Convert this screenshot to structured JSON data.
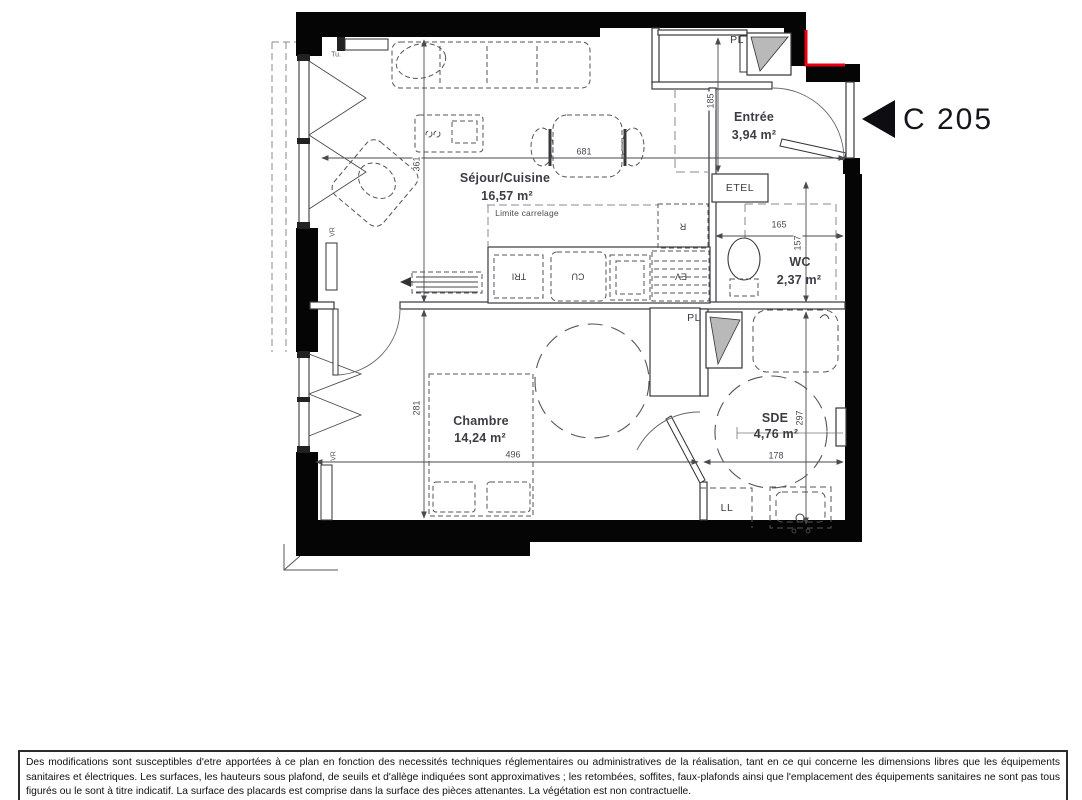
{
  "unit_label": "C 205",
  "rooms": {
    "sejour": {
      "name": "Séjour/Cuisine",
      "area": "16,57 m²"
    },
    "entree": {
      "name": "Entrée",
      "area": "3,94 m²"
    },
    "wc": {
      "name": "WC",
      "area": "2,37 m²"
    },
    "chambre": {
      "name": "Chambre",
      "area": "14,24 m²"
    },
    "sde": {
      "name": "SDE",
      "area": "4,76 m²"
    }
  },
  "labels": {
    "limite_carrelage": "Limite carrelage",
    "pl_top": "PL",
    "pl_mid": "PL",
    "etel": "ETEL",
    "tri": "TRI",
    "cu": "CU",
    "ev": "EV",
    "fridge": "R",
    "ll": "LL",
    "vr_sejour": "VR",
    "vr_chambre": "VR",
    "tu": "Tu."
  },
  "dimensions": {
    "sejour_width": "681",
    "sejour_height": "361",
    "entree_height": "185",
    "wc_width": "165",
    "wc_height": "157",
    "chambre_height": "281",
    "chambre_width": "496",
    "sde_width": "178",
    "sde_height": "297"
  },
  "colors": {
    "wall": "#050505",
    "line": "#38383c",
    "dashed": "#55555a",
    "accent_red": "#e8000f",
    "label": "#3c3c44"
  },
  "disclaimer": "Des modifications sont susceptibles d'etre apportées à ce plan en fonction des necessités techniques réglementaires ou administratives de la réalisation, tant en ce qui concerne les dimensions libres que les équipements sanitaires et électriques. Les surfaces, les hauteurs sous plafond, de seuils et d'allège indiquées sont approximatives ; les retombées, soffites, faux-plafonds ainsi que l'emplacement des équipements sanitaires ne sont pas tous figurés ou le sont à titre indicatif. La surface des placards est comprise dans la surface des pièces attenantes. La végétation est non contractuelle."
}
